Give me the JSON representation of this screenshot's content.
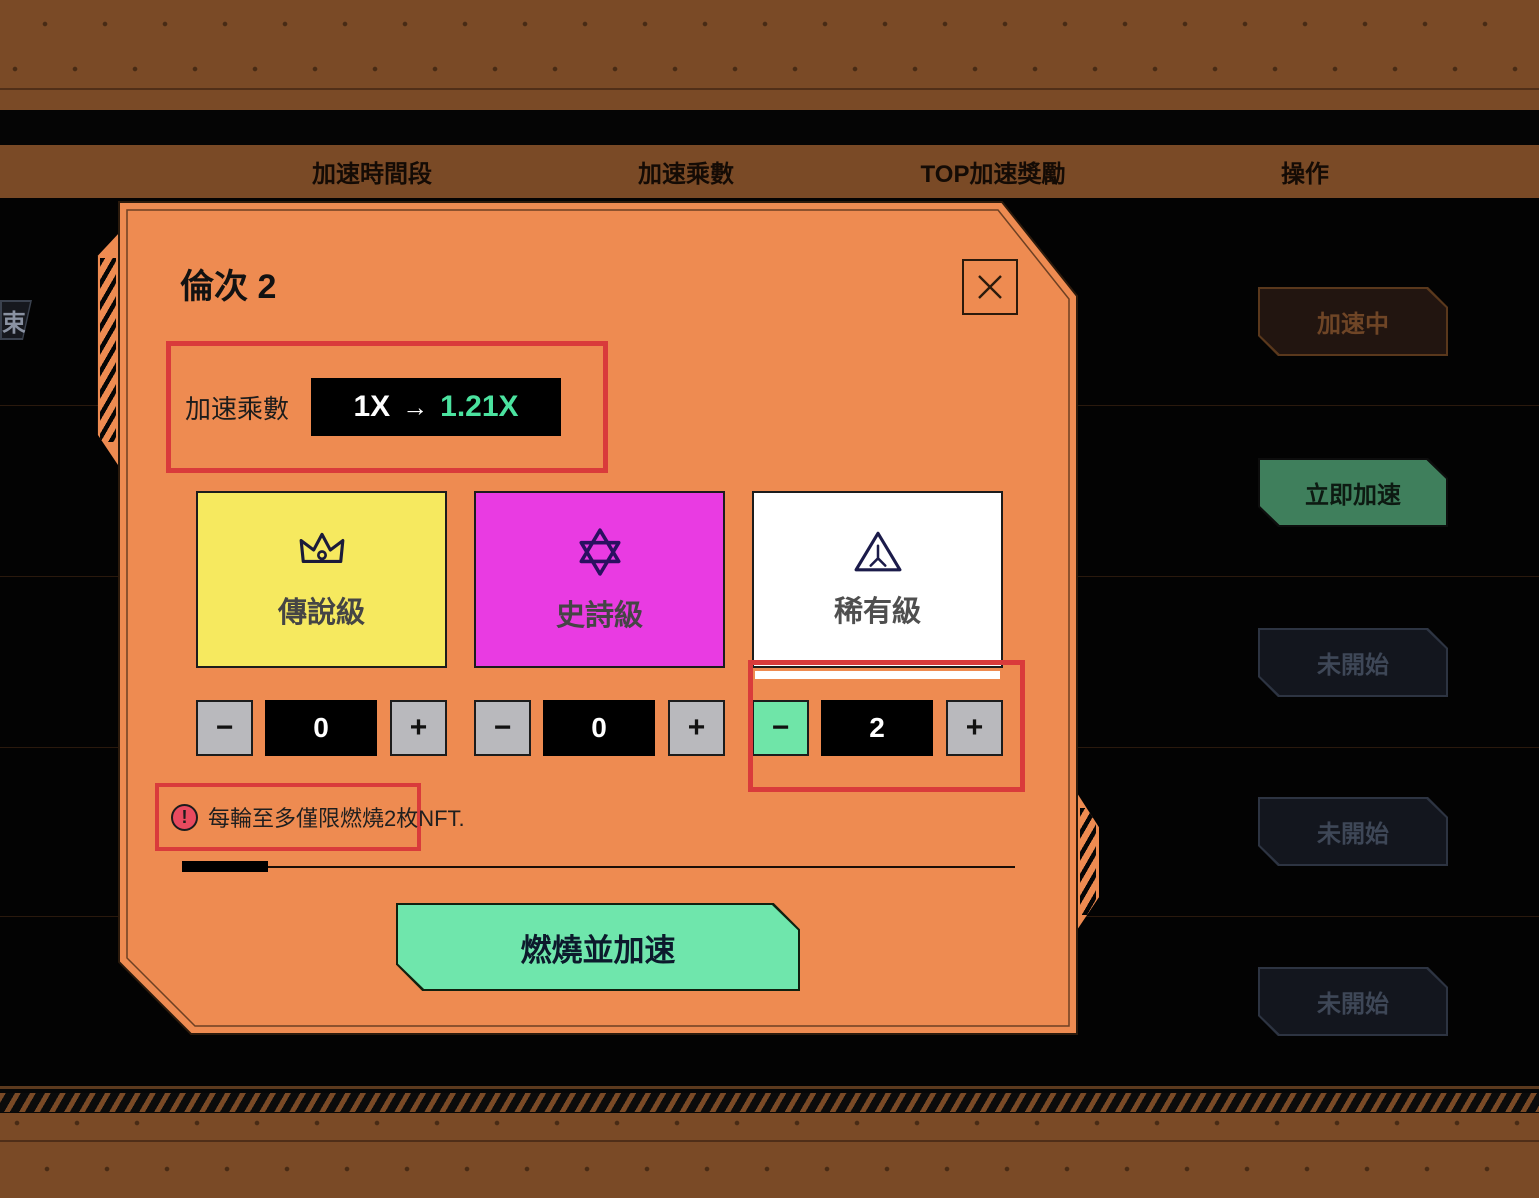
{
  "header": {
    "columns": [
      "加速時間段",
      "加速乘數",
      "TOP加速獎勵",
      "操作"
    ]
  },
  "clipped_chip": {
    "label": "束"
  },
  "action_rows": [
    {
      "label": "加速中",
      "state": "accelerating"
    },
    {
      "label": "立即加速",
      "state": "available"
    },
    {
      "label": "未開始",
      "state": "not-started"
    },
    {
      "label": "未開始",
      "state": "not-started"
    },
    {
      "label": "未開始",
      "state": "not-started"
    }
  ],
  "modal": {
    "title": "倫次 2",
    "multiplier": {
      "label": "加速乘數",
      "from": "1X",
      "arrow": "→",
      "to": "1.21X"
    },
    "cards": [
      {
        "label": "傳說級",
        "icon": "crown-icon",
        "count": "0"
      },
      {
        "label": "史詩級",
        "icon": "hexagram-icon",
        "count": "0"
      },
      {
        "label": "稀有級",
        "icon": "triangle-icon",
        "count": "2"
      }
    ],
    "stepper": {
      "minus_glyph": "−",
      "plus_glyph": "+"
    },
    "warning": {
      "icon_glyph": "!",
      "text": "每輪至多僅限燃燒2枚NFT."
    },
    "burn_label": "燃燒並加速"
  },
  "colors": {
    "modal_orange": "#EE8B51",
    "highlight_red": "#D93B3B",
    "legendary_yellow": "#F6E95F",
    "epic_magenta": "#E93BE2",
    "rare_white": "#FFFFFF",
    "mint_green": "#6FE6AC",
    "accent_teal": "#4BE29F",
    "action_green": "#3F7F5C",
    "band_brown": "#7A4A26"
  }
}
